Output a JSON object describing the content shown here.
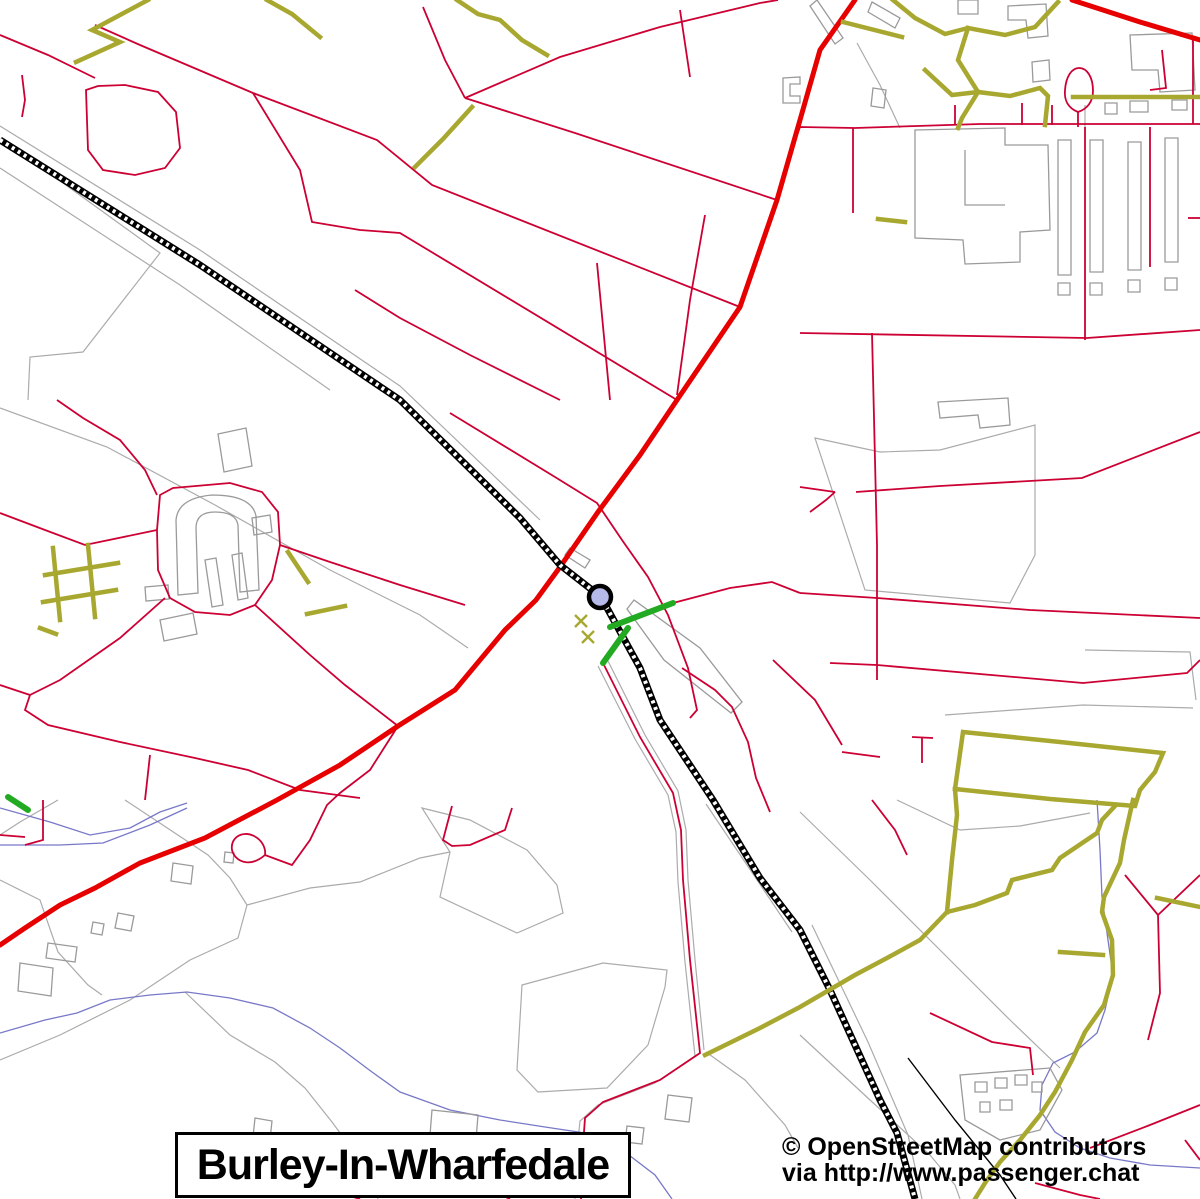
{
  "map": {
    "title": "Burley-In-Wharfedale",
    "attribution": {
      "line1": "© OpenStreetMap contributors",
      "line2": "via http://www.passenger.chat"
    },
    "marker": {
      "label": "railway-station-marker",
      "x": 600,
      "y": 597,
      "radius": 11,
      "fill": "#b6baea",
      "stroke": "#000000",
      "stroke_width": 4.5
    },
    "palette": {
      "road_minor": "#cc0033",
      "road_primary": "#e60000",
      "path_olive": "#a8a830",
      "footpath_green": "#22aa22",
      "stream_blue": "#7878c8",
      "boundary_gray": "#ababab",
      "building_gray": "#9a9a9a",
      "railway_black": "#000000",
      "background": "#ffffff",
      "text": "#000000"
    }
  }
}
